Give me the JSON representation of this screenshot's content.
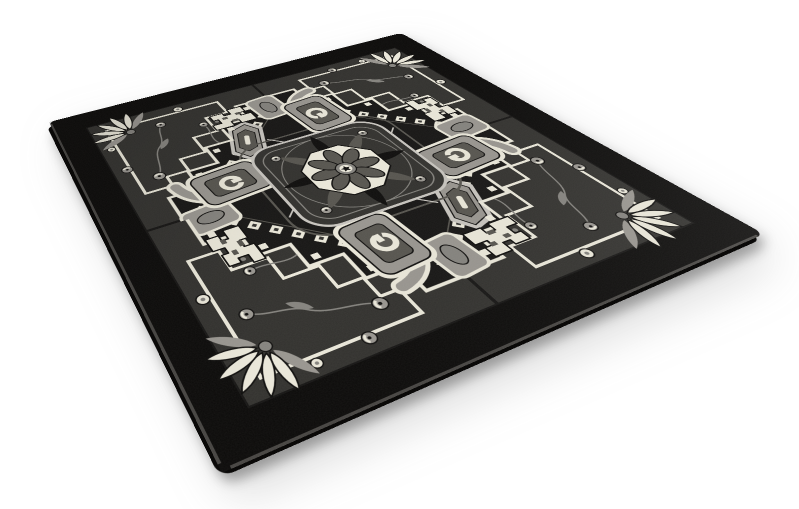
{
  "meta": {
    "description": "3D product render of a square black and gray oriental Heriz-style area rug shown at a perspective angle on a plain white background, with a soft drop shadow under its lower edges",
    "object_type": "area rug render",
    "visible_text": "none"
  },
  "canvas": {
    "width": 799,
    "height": 509,
    "background": "#ffffff"
  },
  "rug": {
    "design_size": 620,
    "corners_px": {
      "left": [
        49,
        122
      ],
      "top": [
        401,
        33
      ],
      "right": [
        764,
        234
      ],
      "bottom": [
        222,
        473
      ]
    },
    "palette": {
      "border": "#0a0908",
      "ground": "#151413",
      "charcoal": "#31302d",
      "cream": "#eae7d9",
      "gray_light": "#c7c4be",
      "gray_mid": "#98958f",
      "gray": "#84827d",
      "gray_dark": "#56544e",
      "ink": "#0d0c0b",
      "edge": "#454340"
    },
    "motifs": [
      "wide black outer border",
      "black central ground in stepped diamond form",
      "charcoal stepped corner panels outlined in cream",
      "diamond chain of small cream squares with dark centers",
      "central charcoal medallion plate with light outline",
      "cream octagon rosette with eight dark petals and star core",
      "radiating black and gray leaf silhouettes",
      "four cream hooked dragon motifs",
      "four gray shield motifs with cream bracket glyph",
      "two elongated hexagonal cartouches",
      "gray corner brackets with oval pads",
      "angular cream trellis vines with gray poppy blossoms",
      "cream lotus leaf clusters in the corners"
    ]
  }
}
